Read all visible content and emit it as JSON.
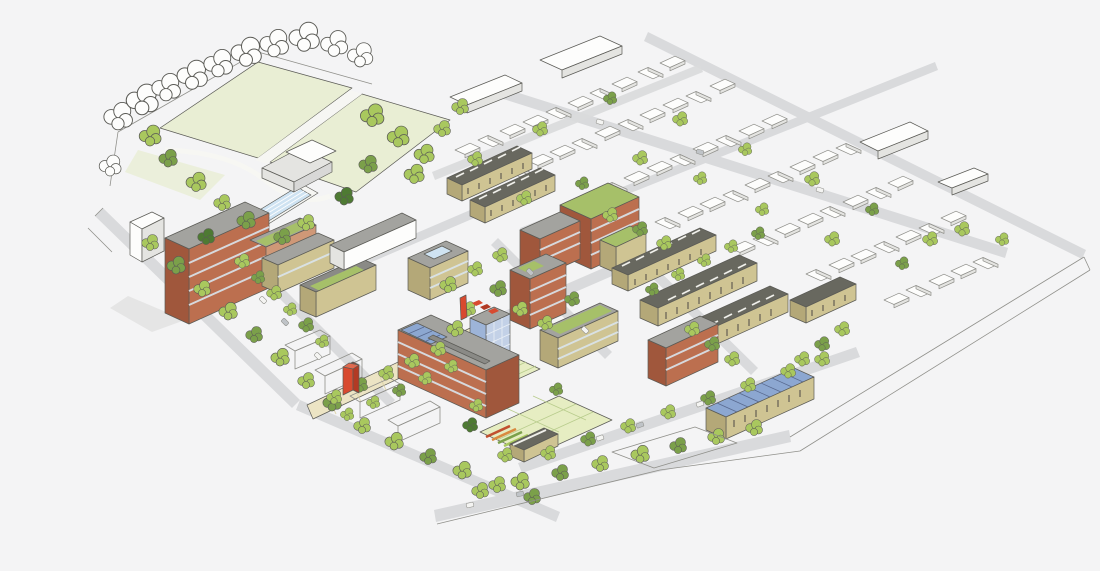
{
  "illustration": {
    "kind": "Hand-drawn aerial masterplan rendering of a mixed-use neighbourhood development",
    "elements": [
      "park-playing-fields",
      "outdoor-swimming-pool",
      "community-pavilion",
      "amphitheatre-lawn",
      "brick-apartment-tower",
      "mid-rise-housing-blocks",
      "townhouse-rows",
      "solar-glass-roofs",
      "green-roofs",
      "rooftop-pool",
      "central-plaza",
      "market-stalls",
      "red-landmark-sculpture",
      "community-garden-allotments",
      "garden-barn",
      "street-trees",
      "existing-neighbourhood-sketch",
      "boundary-streets",
      "parked-cars"
    ]
  },
  "palette": {
    "bg": "#f4f4f5",
    "ink": "#5b5b56",
    "sketch": "#90908b",
    "lawn": "#e9eed4",
    "lawnPath": "#f6f6f3",
    "tree": "#a9c85e",
    "treeDark": "#7ba04a",
    "treeDarker": "#4e7a33",
    "street": "#d9dadc",
    "plaza": "#ece4c4",
    "plazaLine": "#ddd3a8",
    "brick": "#bc6f4f",
    "brickDark": "#a0573c",
    "brickLight": "#cf9877",
    "tan": "#cfc493",
    "tanDark": "#b4a878",
    "greyRoof": "#a3a39f",
    "greyRoofDark": "#8a8a86",
    "darkRoof": "#68685f",
    "glass": "#8ca7d1",
    "glassLight": "#c3d1e7",
    "glassDark": "#9db4d8",
    "pool": "#cfe3f2",
    "greenRoof": "#a6c069",
    "plot": "#e6edc2",
    "plotLine": "#b8cc8c",
    "red": "#d84a2f",
    "redDark": "#b23a24",
    "white": "#fdfdfc",
    "whiteShade": "#e4e4e1",
    "shadow": "#d8d8d7",
    "winStripe": "#d9e4ec"
  }
}
